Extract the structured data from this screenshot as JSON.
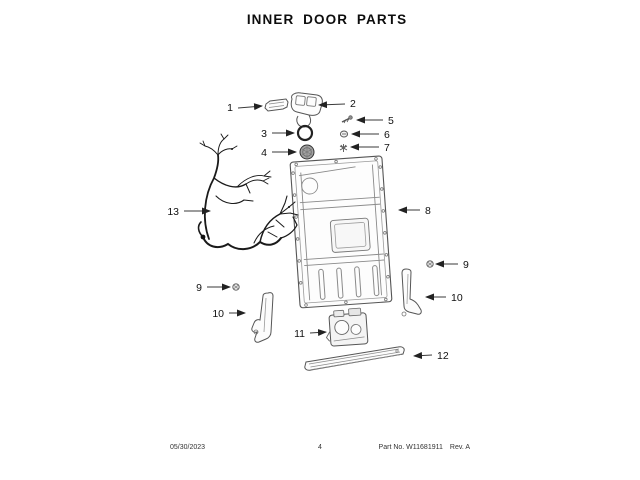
{
  "title": "INNER DOOR PARTS",
  "footer": {
    "date": "05/30/2023",
    "page": "4",
    "part_no": "Part No. W11681911",
    "rev": "Rev. A"
  },
  "callouts": [
    {
      "label": "1"
    },
    {
      "label": "2"
    },
    {
      "label": "3"
    },
    {
      "label": "4"
    },
    {
      "label": "5"
    },
    {
      "label": "6"
    },
    {
      "label": "7"
    },
    {
      "label": "8"
    },
    {
      "label": "9"
    },
    {
      "label": "9"
    },
    {
      "label": "10"
    },
    {
      "label": "10"
    },
    {
      "label": "11"
    },
    {
      "label": "12"
    },
    {
      "label": "13"
    }
  ]
}
